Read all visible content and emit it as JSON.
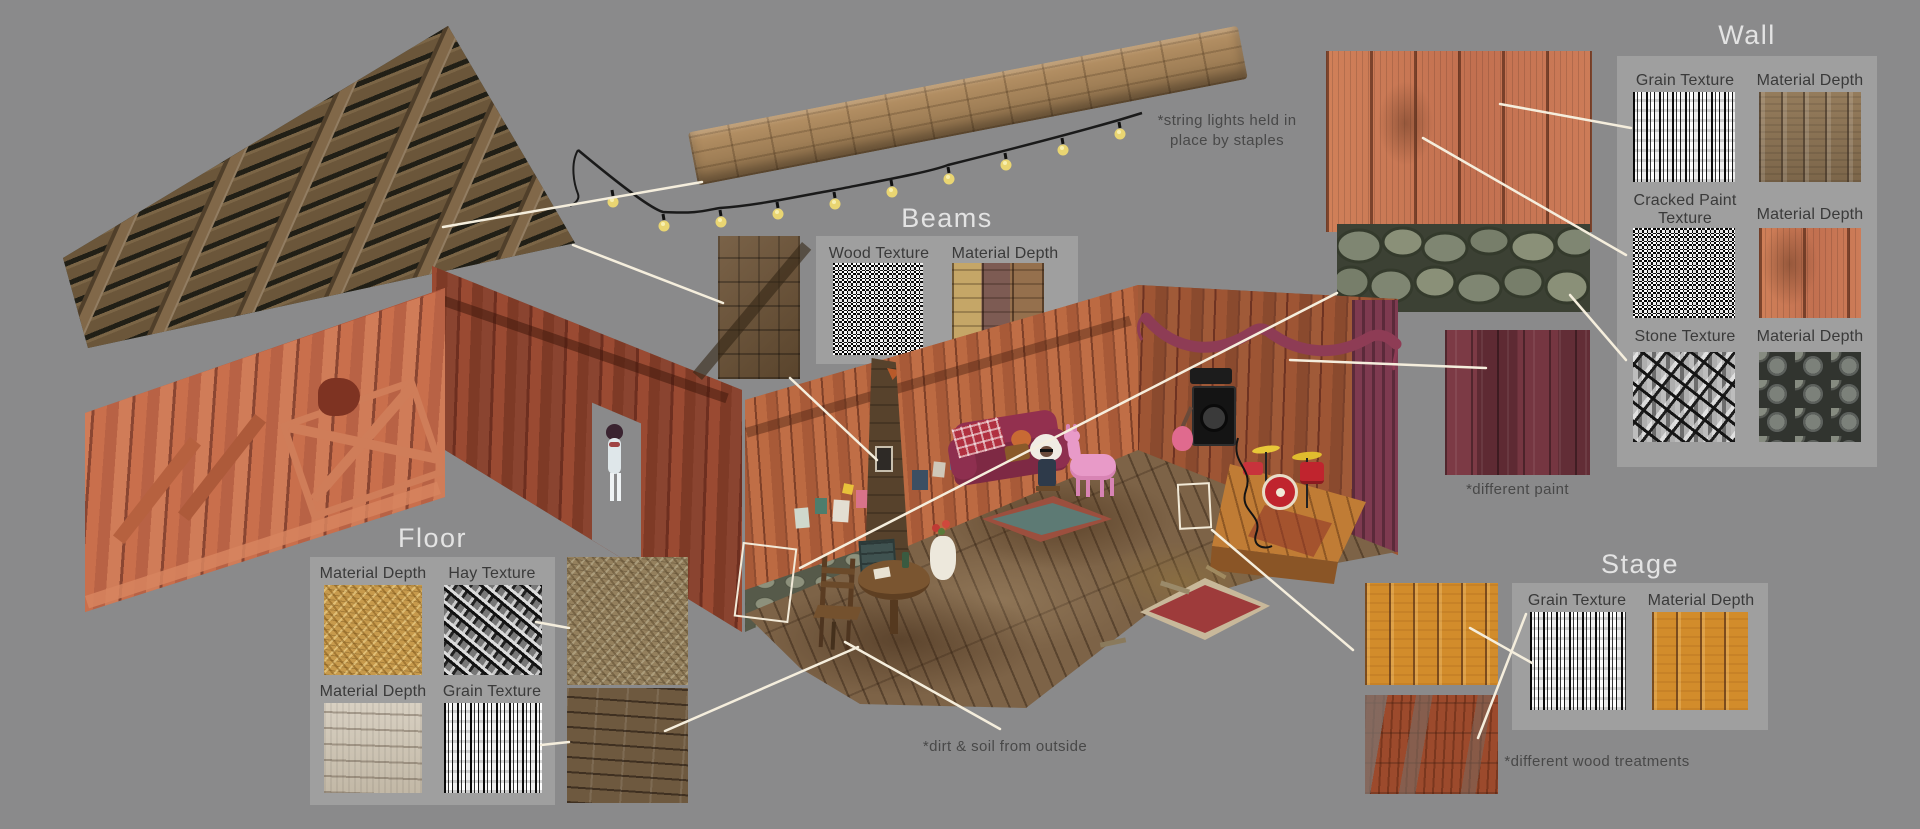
{
  "colors": {
    "background": "#8a8a8b",
    "panel": "#9f9f9f",
    "title_text": "#e3e3e3",
    "label_text": "#3a3a3a",
    "caption_text": "#484848",
    "callout_line": "#f5eedd",
    "barn_salmon": "#c4694a",
    "barn_dark_red": "#93442c",
    "stage_orange": "#c07c35",
    "bunting_maroon": "#8e3c55",
    "different_paint_maroon": "#6e333c"
  },
  "groups": {
    "beams": {
      "title": "Beams",
      "labels": [
        "Wood Texture",
        "Material Depth"
      ]
    },
    "wall": {
      "title": "Wall",
      "labels": [
        "Grain Texture",
        "Material Depth",
        "Cracked Paint Texture",
        "Material Depth",
        "Stone Texture",
        "Material Depth"
      ]
    },
    "floor": {
      "title": "Floor",
      "labels": [
        "Material Depth",
        "Hay Texture",
        "Material Depth",
        "Grain Texture"
      ]
    },
    "stage": {
      "title": "Stage",
      "labels": [
        "Grain Texture",
        "Material Depth"
      ]
    }
  },
  "annotations": {
    "string_lights_line1": "*string lights held in",
    "string_lights_line2": "place by staples",
    "different_paint": "*different paint",
    "dirt_soil": "*dirt & soil from outside",
    "wood_treatments": "*different wood treatments"
  }
}
